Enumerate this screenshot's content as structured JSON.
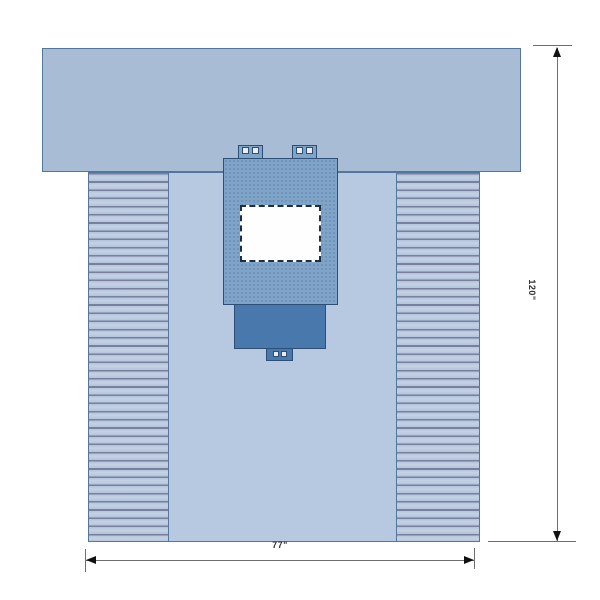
{
  "diagram": {
    "kind": "surgical-drape-technical-drawing",
    "width_dimension": "77\"",
    "height_dimension": "120\""
  },
  "colors": {
    "bg": "#ffffff",
    "top-panel": "#a9bcd6",
    "body": "#b7c9e0",
    "stripe-light": "#b2c4db",
    "stripe-dark": "#79809b",
    "outline": "#54759c",
    "reinforce": "#7fa4c7",
    "reinforce-dot": "#6a8fb5",
    "reinforce-border": "#2e4f73",
    "pouch": "#4878ac",
    "fenestration": "#fefefe",
    "fenestration-border": "#1d2f42",
    "tab-square": "#e8edf4",
    "dim-line": "#6f6f6f",
    "arrow": "#111111",
    "label": "#333333"
  }
}
